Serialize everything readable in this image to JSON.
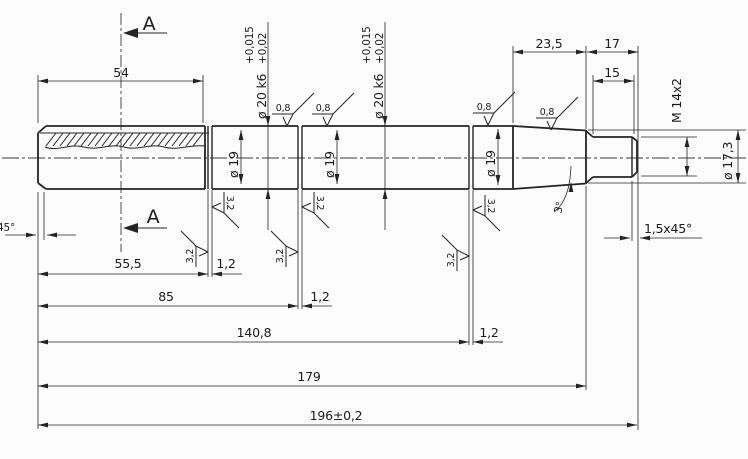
{
  "drawing": {
    "type": "technical-drawing-shaft",
    "colors": {
      "ink": "#242424",
      "background": "#fcfcfc"
    },
    "section_marker": "A",
    "lengths": {
      "knurl": "54",
      "taper": "23,5",
      "thread_total": "17",
      "thread": "15",
      "to_groove1": "55,5",
      "to_groove2": "85",
      "to_groove3": "140,8",
      "to_shoulder": "179",
      "overall": "196±0,2",
      "groove_width": "1,2"
    },
    "diameters": {
      "journal_nominal": "ø 19",
      "journal_fit": "ø 20 k6",
      "tol_upper": "+0,015",
      "tol_lower": "+0,02",
      "thread": "M 14x2",
      "taper_end": "ø 17,3"
    },
    "chamfers": {
      "left": "45°",
      "right": "1,5x45°",
      "taper_angle": "3°"
    },
    "roughness": {
      "fine": "0,8",
      "coarse": "3,2"
    }
  }
}
